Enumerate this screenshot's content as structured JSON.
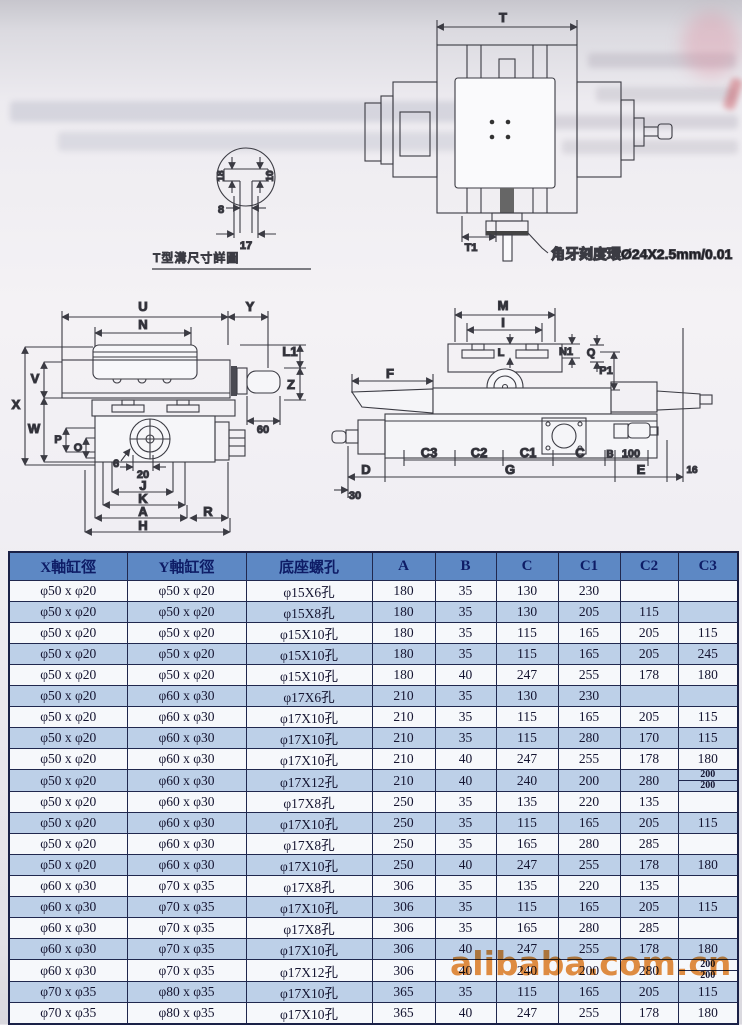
{
  "page": {
    "watermark": "alibaba.com.cn"
  },
  "diagrams": {
    "top_view": {
      "dim_t": "T",
      "dim_t1": "T1",
      "annotation": "角牙刻度環Ø24X2.5mm/0.01"
    },
    "t_slot": {
      "title": "T型溝尺寸詳圖",
      "d18": "18",
      "d10": "10",
      "d8": "8",
      "d17": "17"
    },
    "front_view": {
      "u": "U",
      "y": "Y",
      "n": "N",
      "l1": "L1",
      "v": "V",
      "z": "Z",
      "x": "X",
      "w": "W",
      "p": "P",
      "o": "O",
      "d6": "6",
      "d20": "20",
      "j": "J",
      "k": "K",
      "a": "A",
      "r": "R",
      "h": "H",
      "d60": "60"
    },
    "side_view": {
      "m": "M",
      "i": "I",
      "l": "L",
      "n1": "N1",
      "q": "Q",
      "p1": "P1",
      "f": "F",
      "c3": "C3",
      "c2": "C2",
      "c1": "C1",
      "c": "C",
      "b": "B",
      "d100": "100",
      "d": "D",
      "g": "G",
      "e": "E",
      "d30": "30",
      "d16": "16"
    }
  },
  "table": {
    "headers": [
      "X軸缸徑",
      "Y軸缸徑",
      "底座螺孔",
      "A",
      "B",
      "C",
      "C1",
      "C2",
      "C3"
    ],
    "rows": [
      [
        "φ50 x φ20",
        "φ50 x φ20",
        "φ15X6孔",
        "180",
        "35",
        "130",
        "230",
        "",
        ""
      ],
      [
        "φ50 x φ20",
        "φ50 x φ20",
        "φ15X8孔",
        "180",
        "35",
        "130",
        "205",
        "115",
        ""
      ],
      [
        "φ50 x φ20",
        "φ50 x φ20",
        "φ15X10孔",
        "180",
        "35",
        "115",
        "165",
        "205",
        "115"
      ],
      [
        "φ50 x φ20",
        "φ50 x φ20",
        "φ15X10孔",
        "180",
        "35",
        "115",
        "165",
        "205",
        "245"
      ],
      [
        "φ50 x φ20",
        "φ50 x φ20",
        "φ15X10孔",
        "180",
        "40",
        "247",
        "255",
        "178",
        "180"
      ],
      [
        "φ50 x φ20",
        "φ60 x φ30",
        "φ17X6孔",
        "210",
        "35",
        "130",
        "230",
        "",
        ""
      ],
      [
        "φ50 x φ20",
        "φ60 x φ30",
        "φ17X10孔",
        "210",
        "35",
        "115",
        "165",
        "205",
        "115"
      ],
      [
        "φ50 x φ20",
        "φ60 x φ30",
        "φ17X10孔",
        "210",
        "35",
        "115",
        "280",
        "170",
        "115"
      ],
      [
        "φ50 x φ20",
        "φ60 x φ30",
        "φ17X10孔",
        "210",
        "40",
        "247",
        "255",
        "178",
        "180"
      ],
      [
        "φ50 x φ20",
        "φ60 x φ30",
        "φ17X12孔",
        "210",
        "40",
        "240",
        "200",
        "280",
        "200|200"
      ],
      [
        "φ50 x φ20",
        "φ60 x φ30",
        "φ17X8孔",
        "250",
        "35",
        "135",
        "220",
        "135",
        ""
      ],
      [
        "φ50 x φ20",
        "φ60 x φ30",
        "φ17X10孔",
        "250",
        "35",
        "115",
        "165",
        "205",
        "115"
      ],
      [
        "φ50 x φ20",
        "φ60 x φ30",
        "φ17X8孔",
        "250",
        "35",
        "165",
        "280",
        "285",
        ""
      ],
      [
        "φ50 x φ20",
        "φ60 x φ30",
        "φ17X10孔",
        "250",
        "40",
        "247",
        "255",
        "178",
        "180"
      ],
      [
        "φ60 x φ30",
        "φ70 x φ35",
        "φ17X8孔",
        "306",
        "35",
        "135",
        "220",
        "135",
        ""
      ],
      [
        "φ60 x φ30",
        "φ70 x φ35",
        "φ17X10孔",
        "306",
        "35",
        "115",
        "165",
        "205",
        "115"
      ],
      [
        "φ60 x φ30",
        "φ70 x φ35",
        "φ17X8孔",
        "306",
        "35",
        "165",
        "280",
        "285",
        ""
      ],
      [
        "φ60 x φ30",
        "φ70 x φ35",
        "φ17X10孔",
        "306",
        "40",
        "247",
        "255",
        "178",
        "180"
      ],
      [
        "φ60 x φ30",
        "φ70 x φ35",
        "φ17X12孔",
        "306",
        "40",
        "240",
        "200",
        "280",
        "200|200"
      ],
      [
        "φ70 x φ35",
        "φ80 x φ35",
        "φ17X10孔",
        "365",
        "35",
        "115",
        "165",
        "205",
        "115"
      ],
      [
        "φ70 x φ35",
        "φ80 x φ35",
        "φ17X10孔",
        "365",
        "40",
        "247",
        "255",
        "178",
        "180"
      ]
    ]
  }
}
